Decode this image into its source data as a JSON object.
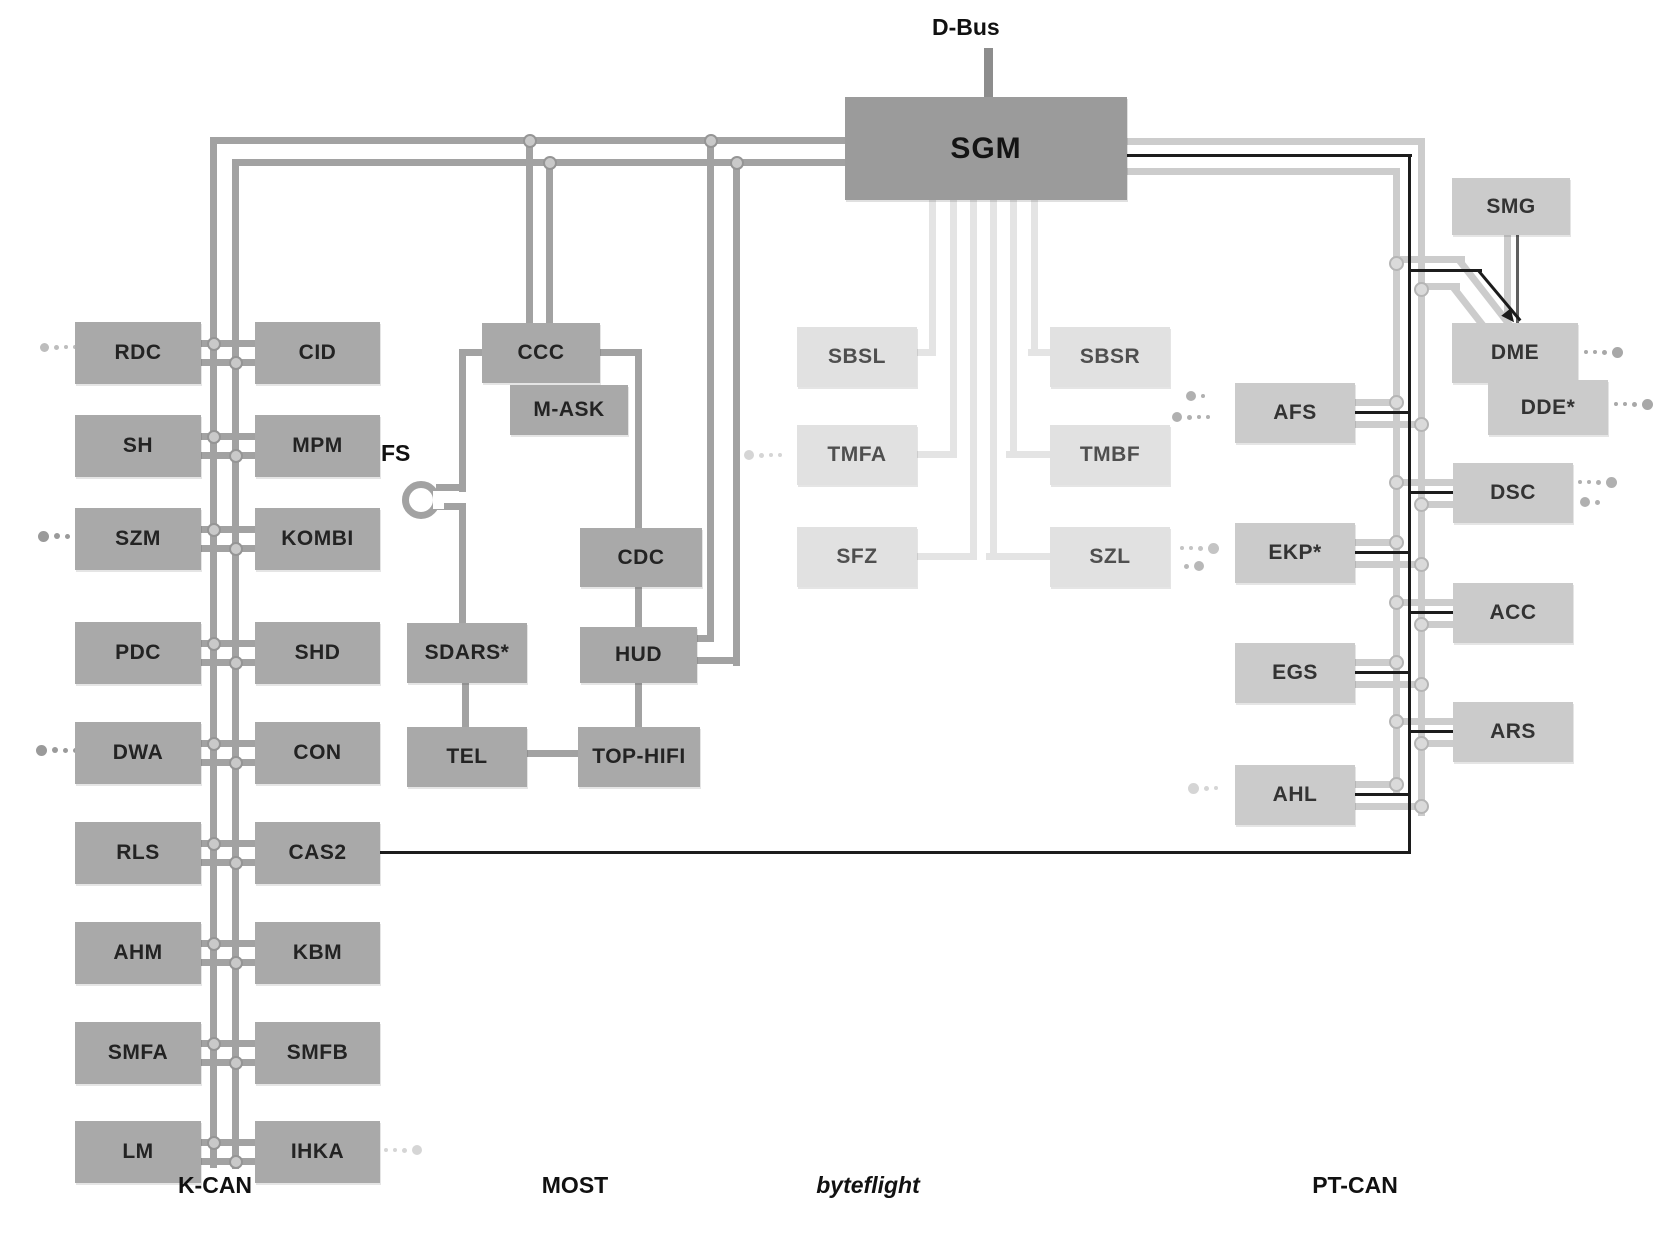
{
  "gateway": {
    "label": "SGM"
  },
  "dbus": {
    "label": "D-Bus"
  },
  "fs": {
    "label": "FS"
  },
  "bus_labels": {
    "kcan": "K-CAN",
    "most": "MOST",
    "byteflight": "byteflight",
    "ptcan": "PT-CAN"
  },
  "nodes": [
    {
      "id": "RDC",
      "label": "RDC",
      "bus": "kcan",
      "tone": "dark"
    },
    {
      "id": "SH",
      "label": "SH",
      "bus": "kcan",
      "tone": "dark"
    },
    {
      "id": "SZM",
      "label": "SZM",
      "bus": "kcan",
      "tone": "dark"
    },
    {
      "id": "PDC",
      "label": "PDC",
      "bus": "kcan",
      "tone": "dark"
    },
    {
      "id": "DWA",
      "label": "DWA",
      "bus": "kcan",
      "tone": "dark"
    },
    {
      "id": "RLS",
      "label": "RLS",
      "bus": "kcan",
      "tone": "dark"
    },
    {
      "id": "AHM",
      "label": "AHM",
      "bus": "kcan",
      "tone": "dark"
    },
    {
      "id": "SMFA",
      "label": "SMFA",
      "bus": "kcan",
      "tone": "dark"
    },
    {
      "id": "LM",
      "label": "LM",
      "bus": "kcan",
      "tone": "dark"
    },
    {
      "id": "CID",
      "label": "CID",
      "bus": "kcan",
      "tone": "dark"
    },
    {
      "id": "MPM",
      "label": "MPM",
      "bus": "kcan",
      "tone": "dark"
    },
    {
      "id": "KOMBI",
      "label": "KOMBI",
      "bus": "kcan",
      "tone": "dark"
    },
    {
      "id": "SHD",
      "label": "SHD",
      "bus": "kcan",
      "tone": "dark"
    },
    {
      "id": "CON",
      "label": "CON",
      "bus": "kcan",
      "tone": "dark"
    },
    {
      "id": "CAS2",
      "label": "CAS2",
      "bus": "kcan",
      "tone": "dark"
    },
    {
      "id": "KBM",
      "label": "KBM",
      "bus": "kcan",
      "tone": "dark"
    },
    {
      "id": "SMFB",
      "label": "SMFB",
      "bus": "kcan",
      "tone": "dark"
    },
    {
      "id": "IHKA",
      "label": "IHKA",
      "bus": "kcan",
      "tone": "dark"
    },
    {
      "id": "CCC",
      "label": "CCC",
      "bus": "most",
      "tone": "dark"
    },
    {
      "id": "MASK",
      "label": "M-ASK",
      "bus": "most",
      "tone": "dark"
    },
    {
      "id": "CDC",
      "label": "CDC",
      "bus": "most",
      "tone": "dark"
    },
    {
      "id": "SDARS",
      "label": "SDARS*",
      "bus": "most",
      "tone": "dark"
    },
    {
      "id": "HUD",
      "label": "HUD",
      "bus": "most",
      "tone": "dark"
    },
    {
      "id": "TEL",
      "label": "TEL",
      "bus": "most",
      "tone": "dark"
    },
    {
      "id": "TOPHIFI",
      "label": "TOP-HIFI",
      "bus": "most",
      "tone": "dark"
    },
    {
      "id": "SBSL",
      "label": "SBSL",
      "bus": "byteflight",
      "tone": "light"
    },
    {
      "id": "SBSR",
      "label": "SBSR",
      "bus": "byteflight",
      "tone": "light"
    },
    {
      "id": "TMFA",
      "label": "TMFA",
      "bus": "byteflight",
      "tone": "light"
    },
    {
      "id": "TMBF",
      "label": "TMBF",
      "bus": "byteflight",
      "tone": "light"
    },
    {
      "id": "SFZ",
      "label": "SFZ",
      "bus": "byteflight",
      "tone": "light"
    },
    {
      "id": "SZL",
      "label": "SZL",
      "bus": "byteflight",
      "tone": "light"
    },
    {
      "id": "AFS",
      "label": "AFS",
      "bus": "ptcan",
      "tone": "mid"
    },
    {
      "id": "EKP",
      "label": "EKP*",
      "bus": "ptcan",
      "tone": "mid"
    },
    {
      "id": "EGS",
      "label": "EGS",
      "bus": "ptcan",
      "tone": "mid"
    },
    {
      "id": "AHL",
      "label": "AHL",
      "bus": "ptcan",
      "tone": "mid"
    },
    {
      "id": "SMG",
      "label": "SMG",
      "bus": "ptcan",
      "tone": "mid"
    },
    {
      "id": "DME",
      "label": "DME",
      "bus": "ptcan",
      "tone": "mid"
    },
    {
      "id": "DDE",
      "label": "DDE*",
      "bus": "ptcan",
      "tone": "mid"
    },
    {
      "id": "DSC",
      "label": "DSC",
      "bus": "ptcan",
      "tone": "mid"
    },
    {
      "id": "ACC",
      "label": "ACC",
      "bus": "ptcan",
      "tone": "mid"
    },
    {
      "id": "ARS",
      "label": "ARS",
      "bus": "ptcan",
      "tone": "mid"
    }
  ],
  "colors": {
    "box_dark": "#a9a9a9",
    "box_dark_text": "#232323",
    "box_light": "#e1e1e1",
    "box_light_text": "#4f4f4f",
    "box_mid": "#cbcbcb",
    "box_mid_text": "#333333",
    "gateway_bg": "#9b9b9b",
    "gateway_text": "#141414",
    "line_kcan": "#a2a2a2",
    "line_byteflight": "#e4e4e4",
    "line_ptcan": "#cccccc",
    "line_black": "#1c1c1c",
    "line_dbus": "#8d8d8d",
    "line_smg": "#606060",
    "junction_bg": "#c9c9c9",
    "junction_border": "#959595",
    "junction_bg_light": "#dadada",
    "junction_border_light": "#b5b5b5"
  }
}
